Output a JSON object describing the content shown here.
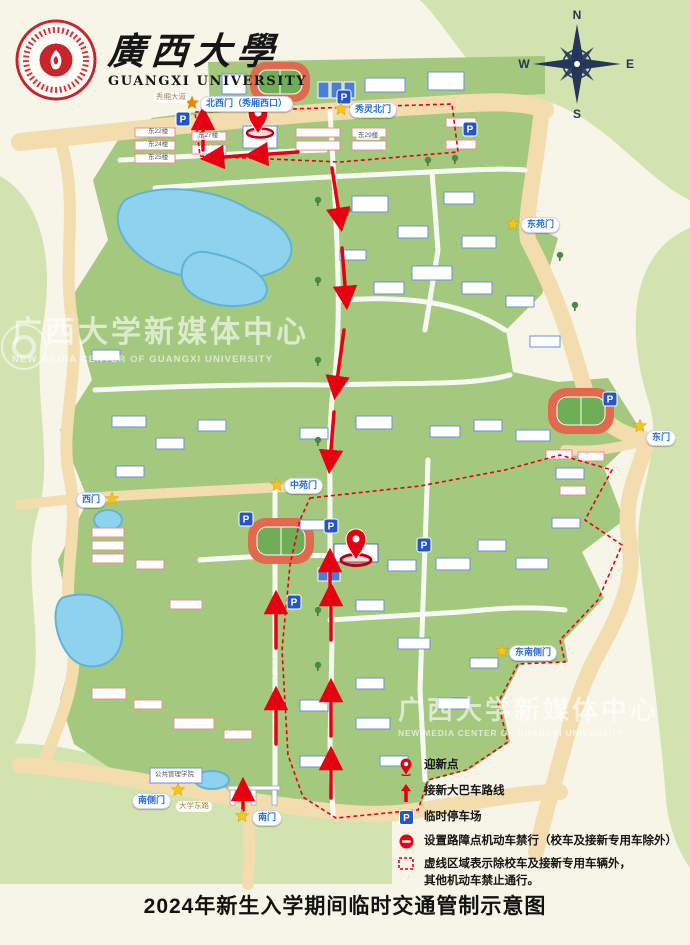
{
  "header": {
    "title_cn": "廣西大學",
    "title_en": "GUANGXI UNIVERSITY"
  },
  "compass": {
    "n": "N",
    "e": "E",
    "s": "S",
    "w": "W"
  },
  "map": {
    "parking_letter": "P",
    "gates": [
      {
        "name": "北西门（秀厢西口）"
      },
      {
        "name": "秀灵北门"
      },
      {
        "name": "东苑门"
      },
      {
        "name": "东门"
      },
      {
        "name": "西门"
      },
      {
        "name": "中苑门"
      },
      {
        "name": "南侧门"
      },
      {
        "name": "南门"
      },
      {
        "name": "东南侧门"
      }
    ],
    "road_labels": [
      {
        "name": "秀厢大道"
      },
      {
        "name": "大学东路"
      }
    ],
    "building_labels": [
      {
        "name": "东22楼"
      },
      {
        "name": "东24楼"
      },
      {
        "name": "东25楼"
      },
      {
        "name": "东27楼"
      },
      {
        "name": "东29楼"
      },
      {
        "name": "公共管理学院"
      }
    ],
    "watermark": {
      "cn": "广西大学新媒体中心",
      "en": "NEW MEDIA CENTER OF GUANGXI UNIVERSITY"
    }
  },
  "legend": {
    "items": [
      {
        "icon": "pin-icon",
        "label": "迎新点"
      },
      {
        "icon": "arrow-up-icon",
        "label": "接新大巴车路线"
      },
      {
        "icon": "parking-icon",
        "label": "临时停车场"
      },
      {
        "icon": "no-entry-icon",
        "label": "设置路障点机动车禁行（校车及接新专用车除外）"
      },
      {
        "icon": "dashed-area-icon",
        "label": "虚线区域表示除校车及接新专用车辆外，\n其他机动车禁止通行。"
      }
    ]
  },
  "footer": {
    "title": "2024年新生入学期间临时交通管制示意图"
  },
  "colors": {
    "accent_red": "#e60012",
    "parking_blue": "#2456c4",
    "campus_green": "#a4c87e",
    "outer_green": "#d2e3b0",
    "road_tan": "#f3ddae",
    "lake_blue": "#8ed2ee",
    "compass_navy": "#25365a",
    "star_yellow": "#f6c517",
    "star_orange": "#f08300",
    "seal_red": "#c8242b"
  }
}
